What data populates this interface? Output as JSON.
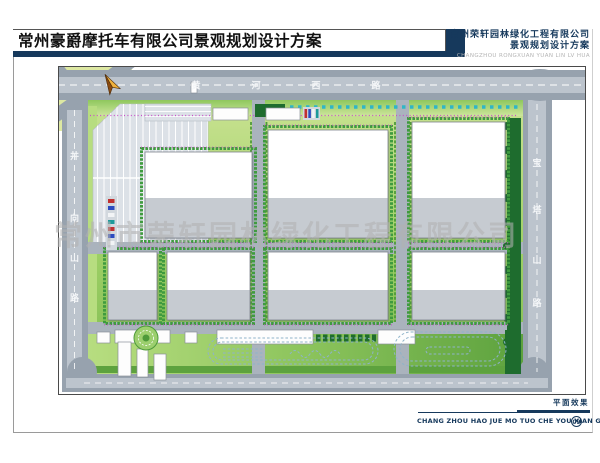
{
  "header": {
    "title": "常州豪爵摩托车有限公司景观规划设计方案",
    "company": {
      "name_cn": "常州荣轩园林绿化工程有限公司",
      "subtitle_cn": "景观规划设计方案",
      "name_en": "CHANGZHOU RONGXUAN YUAN LIN LV HUA"
    }
  },
  "footer": {
    "view_label": "平面效果",
    "caption": "CHANG ZHOU HAO JUE MO TUO CHE YOU XIAN GONG SI",
    "sheet_number": "09"
  },
  "watermark": "常州市荣轩园林绿化工程有限公司",
  "map": {
    "roads": {
      "top_name": "黄河西路",
      "top_chars": [
        "黄",
        "河",
        "西",
        "路"
      ],
      "left_name": "井向山路",
      "left_chars": [
        "井",
        "向",
        "山",
        "路"
      ],
      "right_name": "宝塔山路",
      "right_chars": [
        "宝",
        "塔",
        "山",
        "路"
      ]
    },
    "icons": {
      "compass": "north-arrow"
    }
  },
  "colors": {
    "accent_navy": "#16395c",
    "road_gray": "#97a2ae",
    "road_center": "#bcc4cd",
    "site_green_light": "#cde69c",
    "site_green": "#7fbb52",
    "tree_green": "#1e6c2e",
    "hedge_green": "#3f9b3f",
    "flower_magenta": "#c94fc9",
    "shrub_cyan": "#2fb6c6",
    "building_gray": "#c6cbd1",
    "quadrant_yellow_green": "#dde8a2"
  }
}
